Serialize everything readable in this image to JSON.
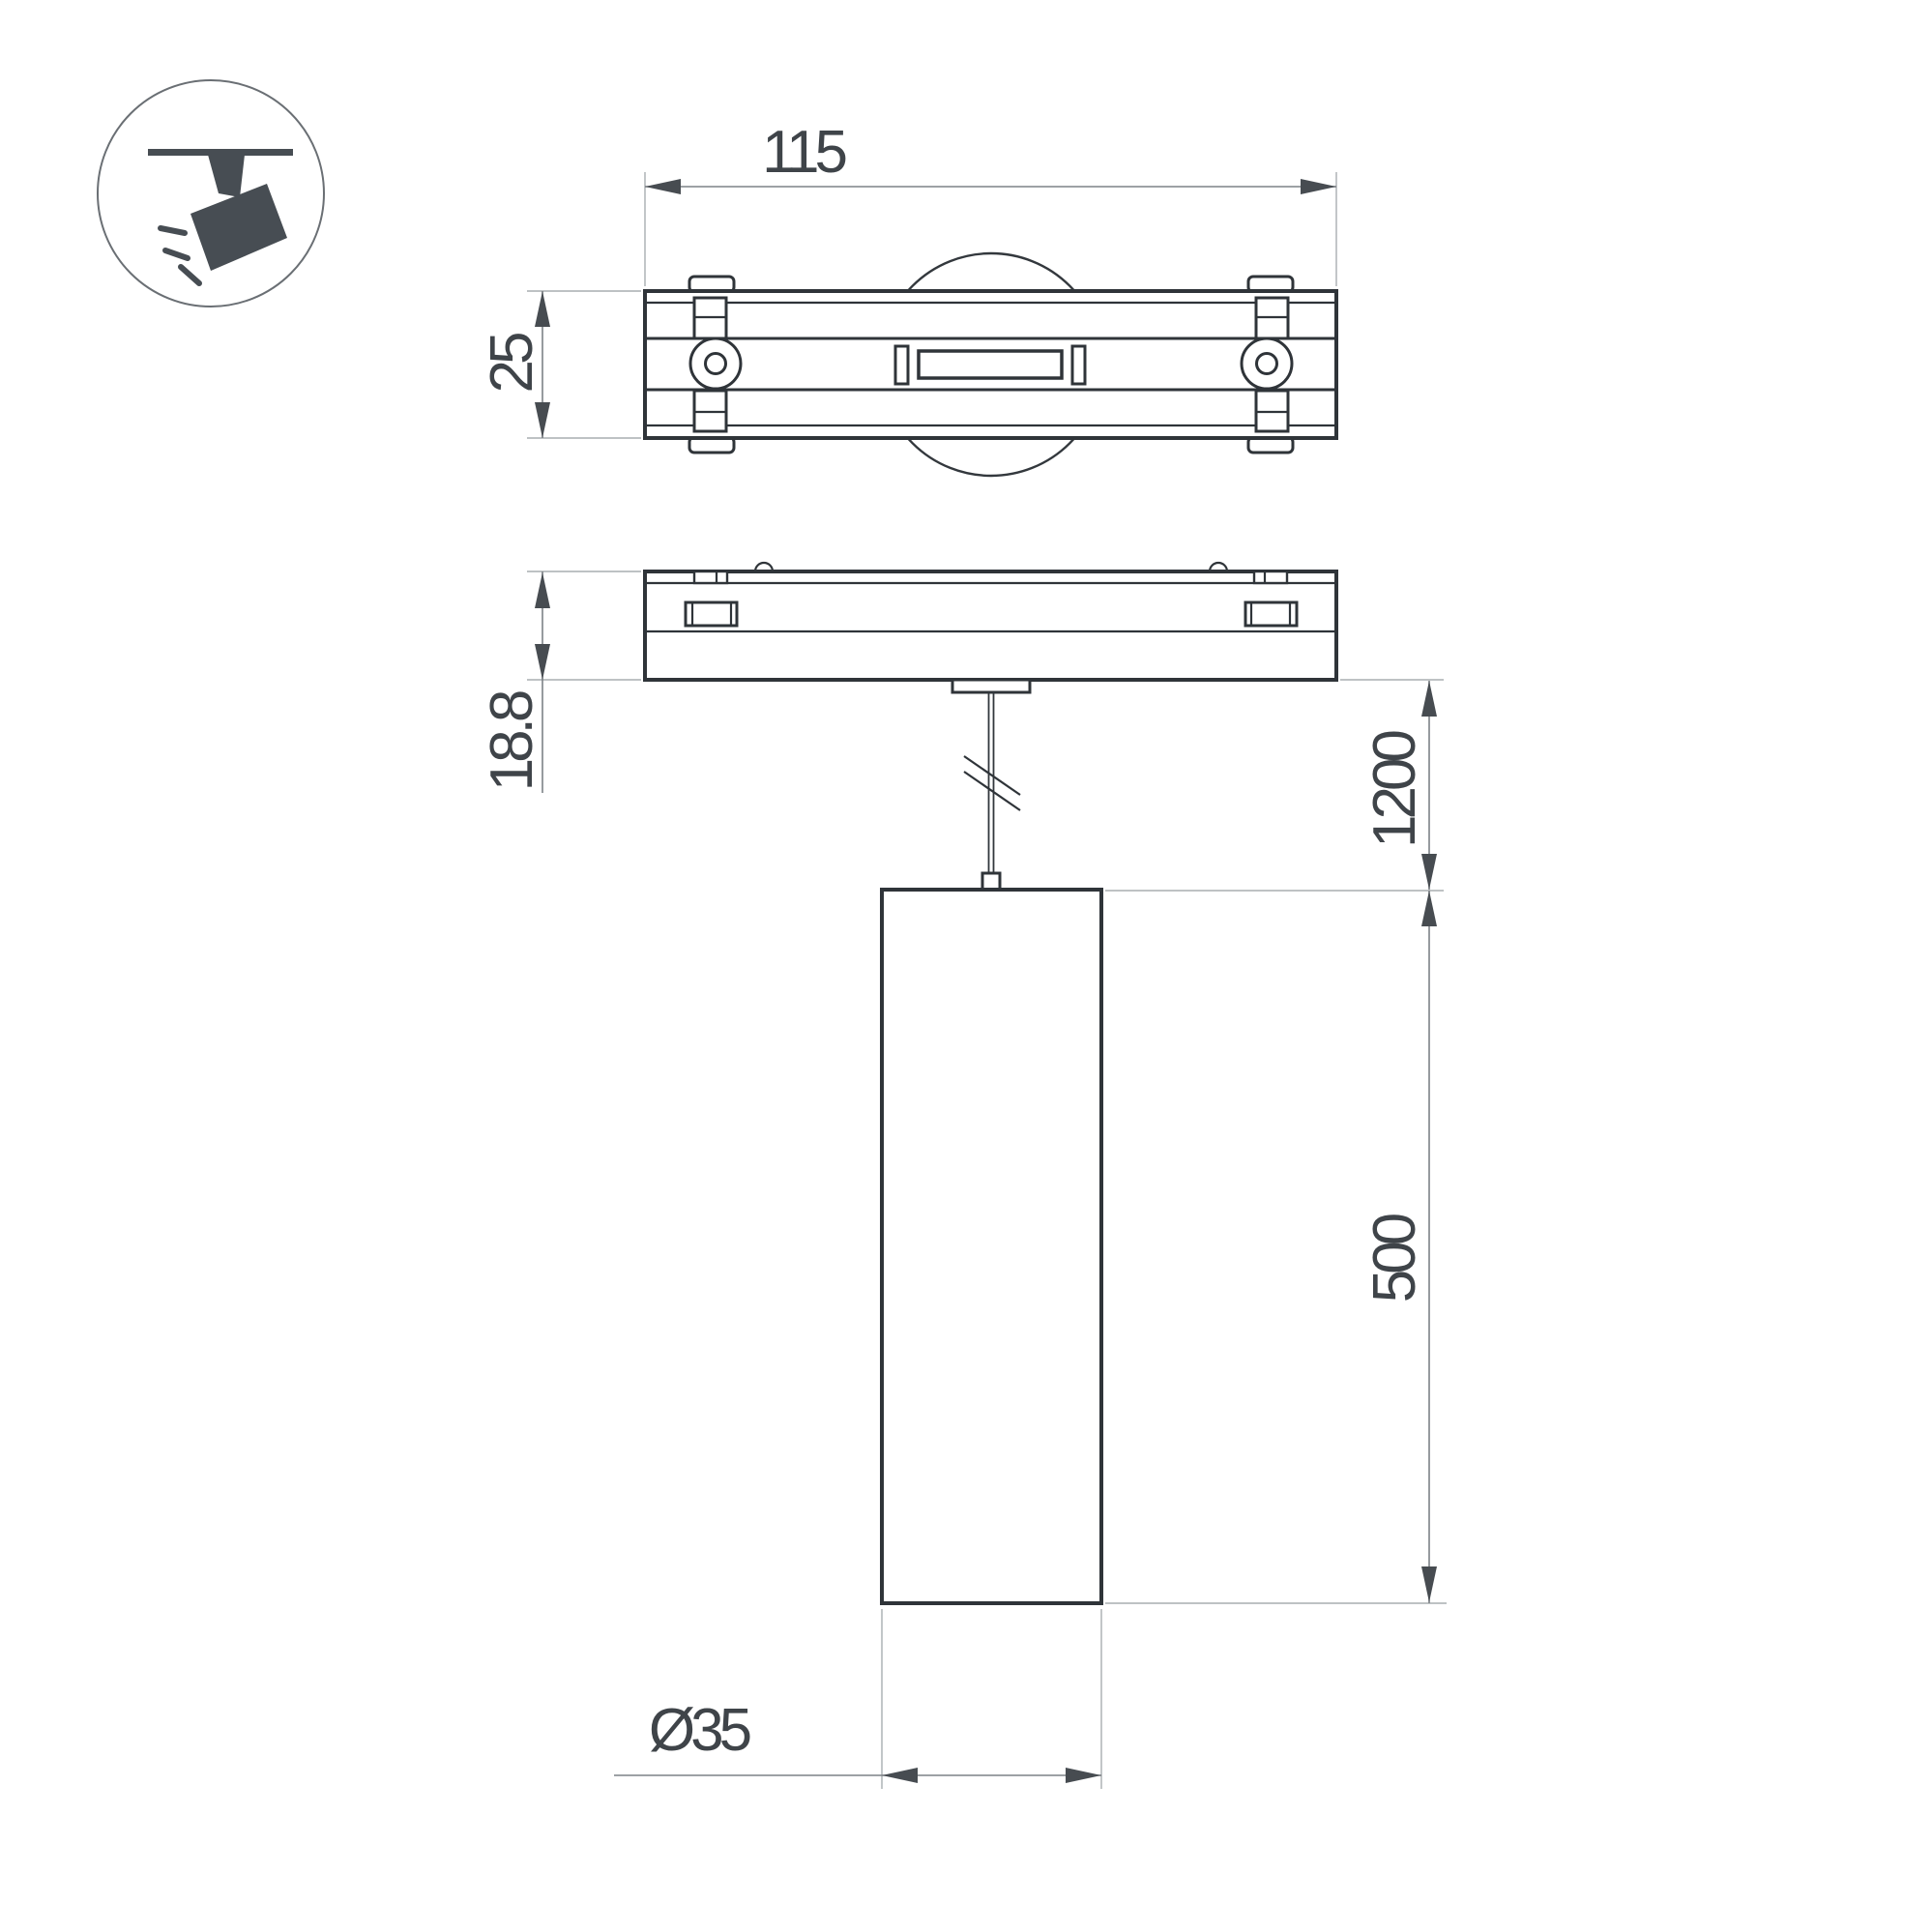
{
  "icon": {
    "name": "track-spotlight",
    "color": "#474d53"
  },
  "dimensions": {
    "track_width": "115",
    "track_depth": "25",
    "track_height": "18.8",
    "suspension_length": "1200",
    "lamp_length": "500",
    "lamp_diameter": "Ø35"
  },
  "colors": {
    "background": "#ffffff",
    "outline": "#2f3439",
    "dimension_line": "#7d8287",
    "extension_line": "#a9adb0",
    "arrowhead": "#474c51",
    "label_text": "#3f4449"
  }
}
